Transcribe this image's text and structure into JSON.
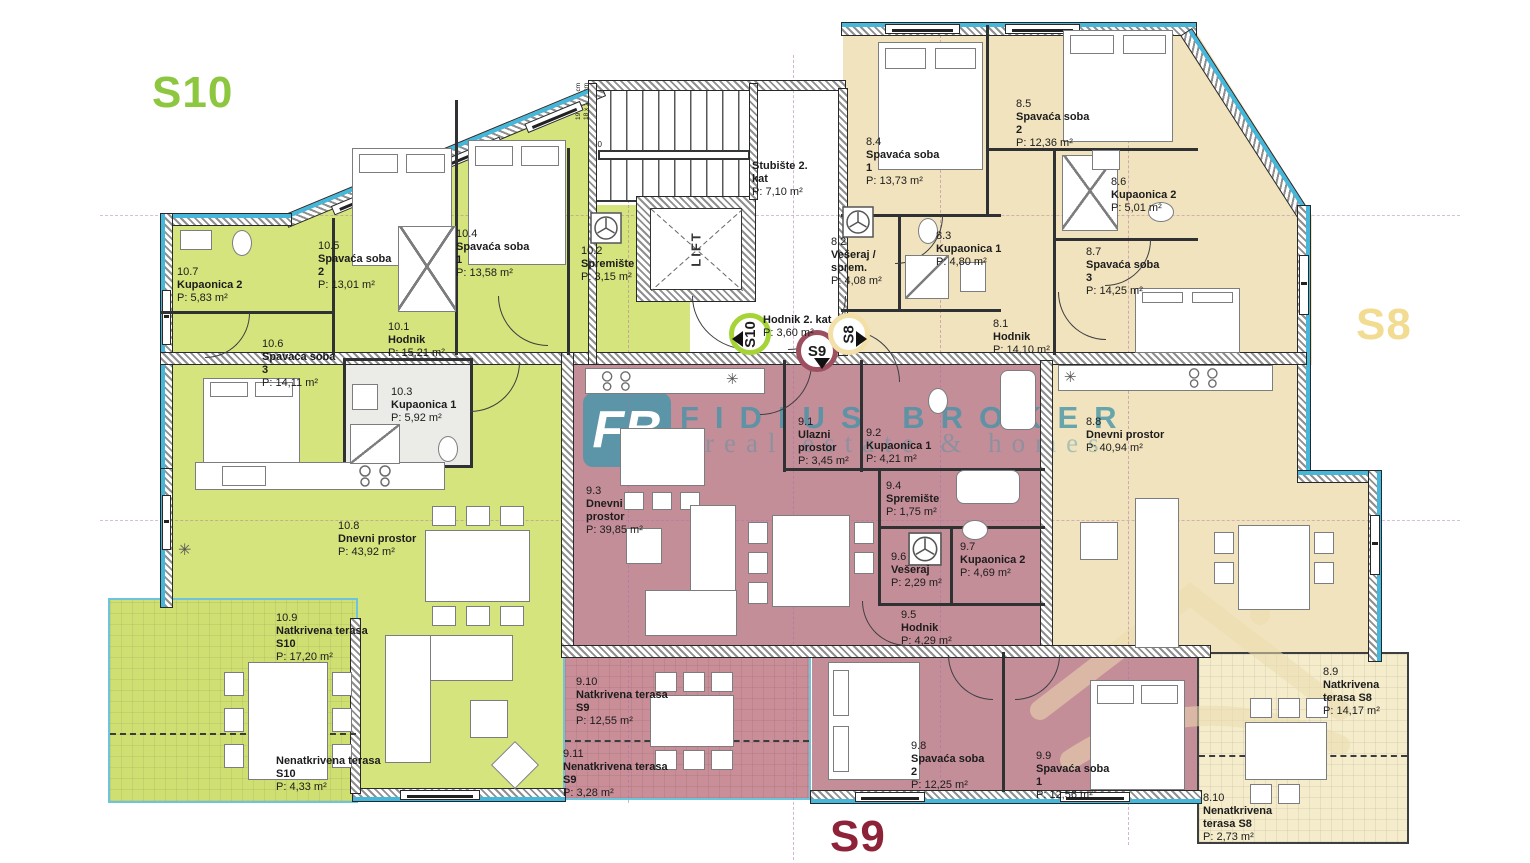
{
  "apartments": [
    {
      "id": "S10",
      "label": "S10",
      "accent": "#8dc63f",
      "fill": "#d5e47c",
      "rooms": [
        {
          "num": "10.1",
          "name": "Hodnik",
          "area": "P: 15,21 m²"
        },
        {
          "num": "10.2",
          "name": "Spremište",
          "area": "P: 3,15 m²"
        },
        {
          "num": "10.3",
          "name": "Kupaonica 1",
          "area": "P: 5,92 m²"
        },
        {
          "num": "10.4",
          "name": "Spavaća soba 1",
          "area": "P: 13,58 m²"
        },
        {
          "num": "10.5",
          "name": "Spavaća soba 2",
          "area": "P: 13,01 m²"
        },
        {
          "num": "10.6",
          "name": "Spavaća soba 3",
          "area": "P: 14,11 m²"
        },
        {
          "num": "10.7",
          "name": "Kupaonica 2",
          "area": "P: 5,83 m²"
        },
        {
          "num": "10.8",
          "name": "Dnevni prostor",
          "area": "P: 43,92 m²"
        },
        {
          "num": "10.9",
          "name": "Natkrivena terasa S10",
          "area": "P: 17,20 m²"
        },
        {
          "num": "",
          "name": "Nenatkrivena terasa S10",
          "area": "P: 4,33 m²"
        }
      ]
    },
    {
      "id": "S9",
      "label": "S9",
      "accent": "#8e2238",
      "fill": "#c48e99",
      "rooms": [
        {
          "num": "9.1",
          "name": "Ulazni prostor",
          "area": "P: 3,45 m²"
        },
        {
          "num": "9.2",
          "name": "Kupaonica 1",
          "area": "P: 4,21 m²"
        },
        {
          "num": "9.3",
          "name": "Dnevni prostor",
          "area": "P: 39,85 m²"
        },
        {
          "num": "9.4",
          "name": "Spremište",
          "area": "P: 1,75 m²"
        },
        {
          "num": "9.5",
          "name": "Hodnik",
          "area": "P: 4,29 m²"
        },
        {
          "num": "9.6",
          "name": "Vešeraj",
          "area": "P: 2,29 m²"
        },
        {
          "num": "9.7",
          "name": "Kupaonica 2",
          "area": "P: 4,69 m²"
        },
        {
          "num": "9.8",
          "name": "Spavaća soba 2",
          "area": "P: 12,25 m²"
        },
        {
          "num": "9.9",
          "name": "Spavaća soba 1",
          "area": "P: 12,56 m²"
        },
        {
          "num": "9.10",
          "name": "Natkrivena terasa S9",
          "area": "P: 12,55 m²"
        },
        {
          "num": "9.11",
          "name": "Nenatkrivena terasa S9",
          "area": "P: 3,28 m²"
        }
      ]
    },
    {
      "id": "S8",
      "label": "S8",
      "accent": "#f2dc92",
      "fill": "#f1e3bd",
      "rooms": [
        {
          "num": "8.1",
          "name": "Hodnik",
          "area": "P: 14,10 m²"
        },
        {
          "num": "8.2",
          "name": "Vešeraj / sprem.",
          "area": "P: 4,08 m²"
        },
        {
          "num": "8.3",
          "name": "Kupaonica 1",
          "area": "P: 4,80 m²"
        },
        {
          "num": "8.4",
          "name": "Spavaća soba 1",
          "area": "P: 13,73 m²"
        },
        {
          "num": "8.5",
          "name": "Spavaća soba 2",
          "area": "P: 12,36 m²"
        },
        {
          "num": "8.6",
          "name": "Kupaonica 2",
          "area": "P: 5,01 m²"
        },
        {
          "num": "8.7",
          "name": "Spavaća soba 3",
          "area": "P: 14,25 m²"
        },
        {
          "num": "8.8",
          "name": "Dnevni prostor",
          "area": "P: 40,94 m²"
        },
        {
          "num": "8.9",
          "name": "Natkrivena terasa S8",
          "area": "P: 14,17 m²"
        },
        {
          "num": "8.10",
          "name": "Nenatkrivena terasa S8",
          "area": "P: 2,73 m²"
        }
      ]
    }
  ],
  "common": {
    "stair": {
      "name": "Stubište 2. kat",
      "area": "P: 7,10 m²"
    },
    "hall": {
      "name": "Hodnik 2. kat",
      "area": "P: 3,60 m²"
    },
    "lift": "LIFT",
    "stair_dim1": "19 x 15,1 cm",
    "stair_dim2": "18 x 28,0 cm",
    "stair_num": "10"
  },
  "badges": [
    {
      "label": "S10",
      "dir": "left",
      "ring": "#a6d436"
    },
    {
      "label": "S9",
      "dir": "down",
      "ring": "#9c4f5f"
    },
    {
      "label": "S8",
      "dir": "right",
      "ring": "#f3e0a8"
    }
  ],
  "icons": {
    "snowflake": "✳"
  },
  "watermark": {
    "logo": "FB",
    "brand": "FIDIUS BROKER",
    "tagline": "real estate & homes"
  },
  "colors": {
    "wall_insulation": "#45b7da",
    "s10_green": "#d5e47c",
    "s9_rose": "#c48e99",
    "s8_beige": "#f1e3bd"
  }
}
